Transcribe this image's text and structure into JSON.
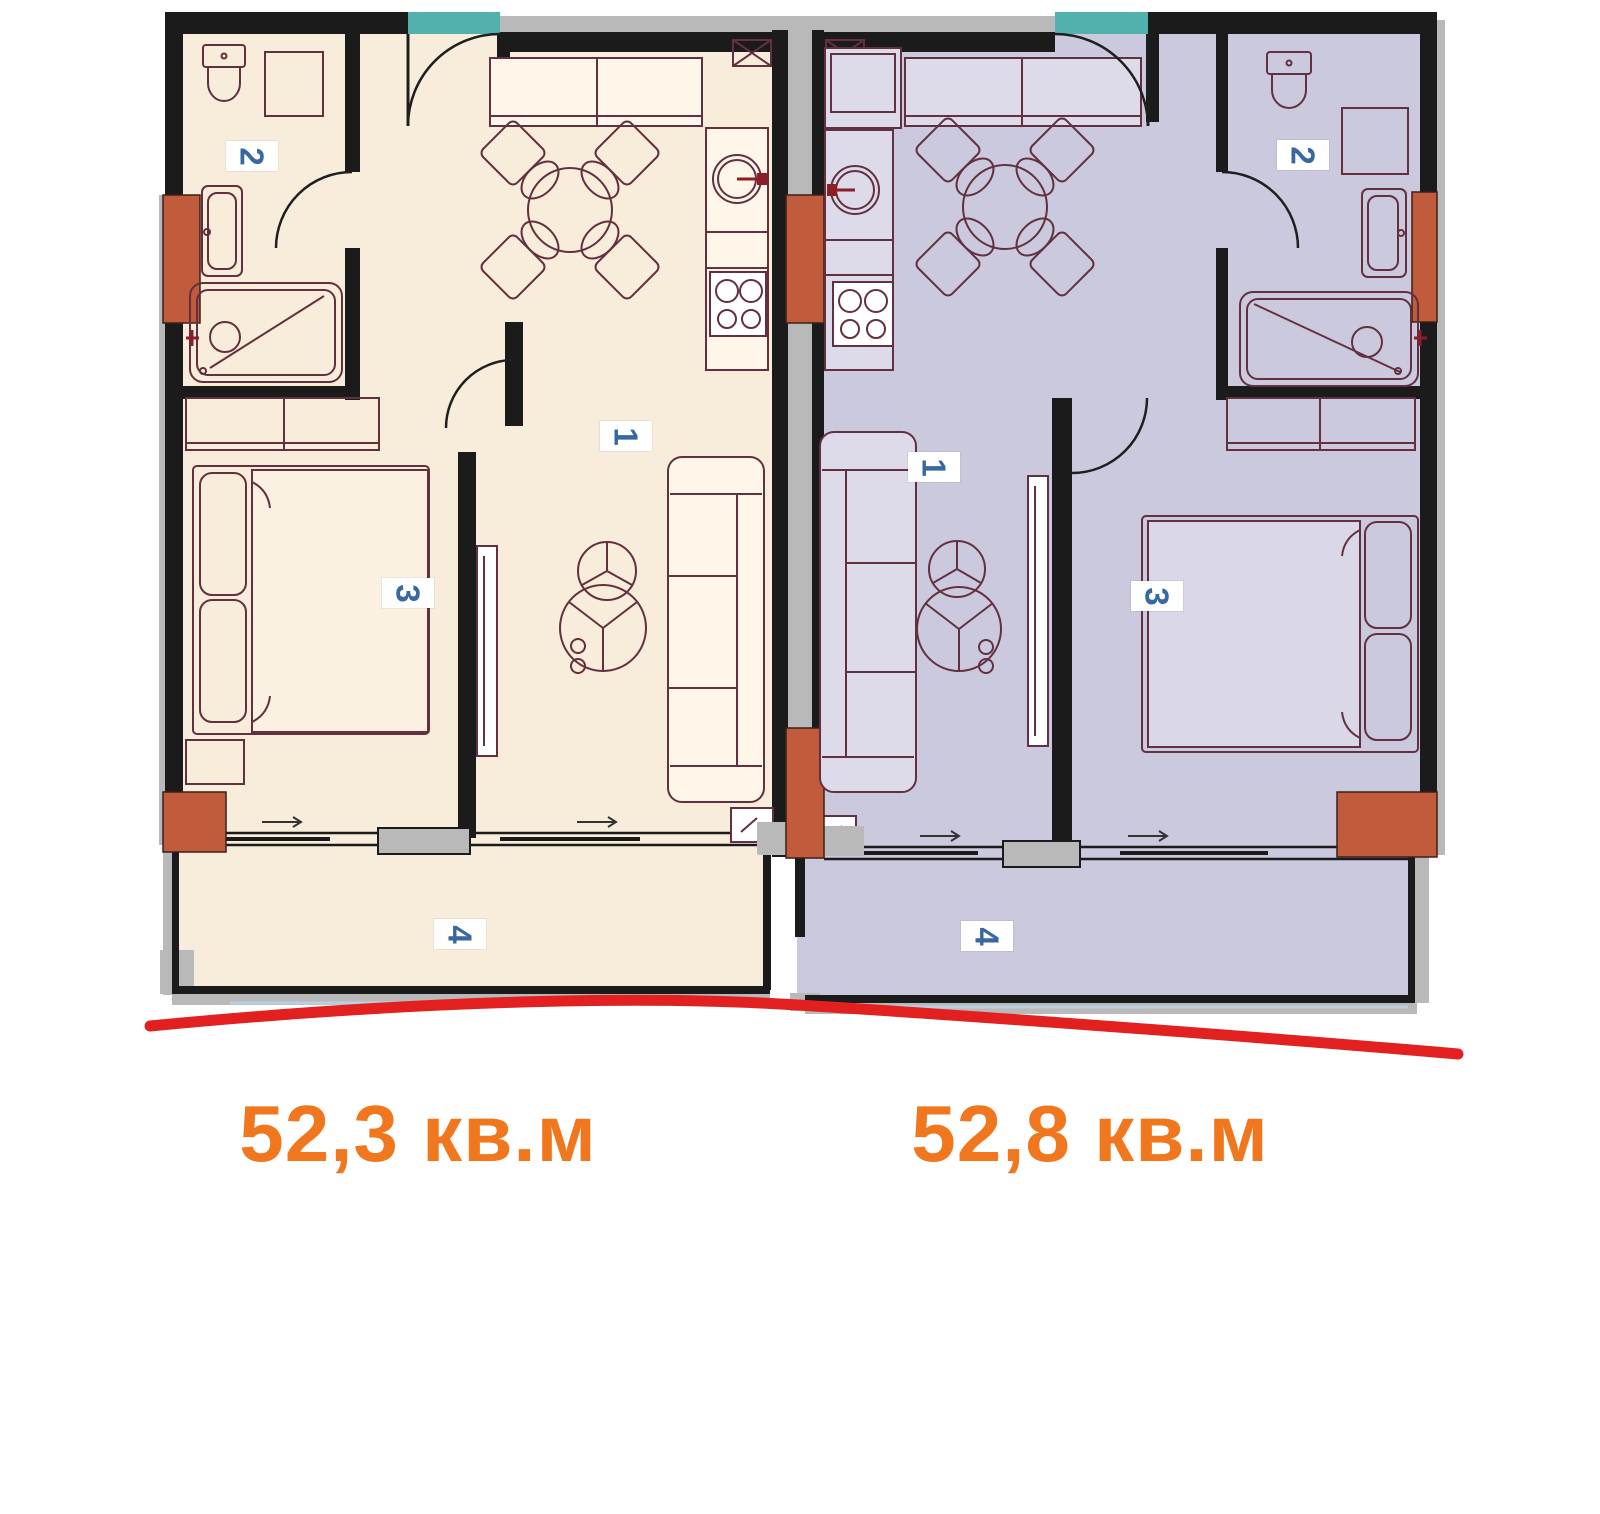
{
  "page": {
    "background": "#ffffff",
    "type": "apartment floor plan, two mirrored units"
  },
  "colors": {
    "floor-left": "#f8ecdb",
    "floor-right": "#cbc9de",
    "wall": "#1b1b1b",
    "trim-gray": "#b9b9b9",
    "teal": "#52b1ad",
    "column": "#c05b3c",
    "furniture-line": "#63303f",
    "furniture-fill-left": "#fdf6e9",
    "furniture-fill-right": "#dddbe9",
    "bed-left": "#fbf1e2",
    "bed-right": "#d9d7e8",
    "accent-dark-red": "#8b1e26",
    "red-line": "#e32020",
    "glass-blue": "#b7d0e4",
    "number-blue": "#39679f",
    "area-orange": "#f0771d",
    "chip-white": "#ffffff"
  },
  "apartments": [
    {
      "side": "left",
      "area_label": "52,3 кв.м",
      "rooms": [
        {
          "number": "1"
        },
        {
          "number": "2"
        },
        {
          "number": "3"
        },
        {
          "number": "4"
        }
      ]
    },
    {
      "side": "right",
      "area_label": "52,8 кв.м",
      "rooms": [
        {
          "number": "1"
        },
        {
          "number": "2"
        },
        {
          "number": "3"
        },
        {
          "number": "4"
        }
      ]
    }
  ]
}
